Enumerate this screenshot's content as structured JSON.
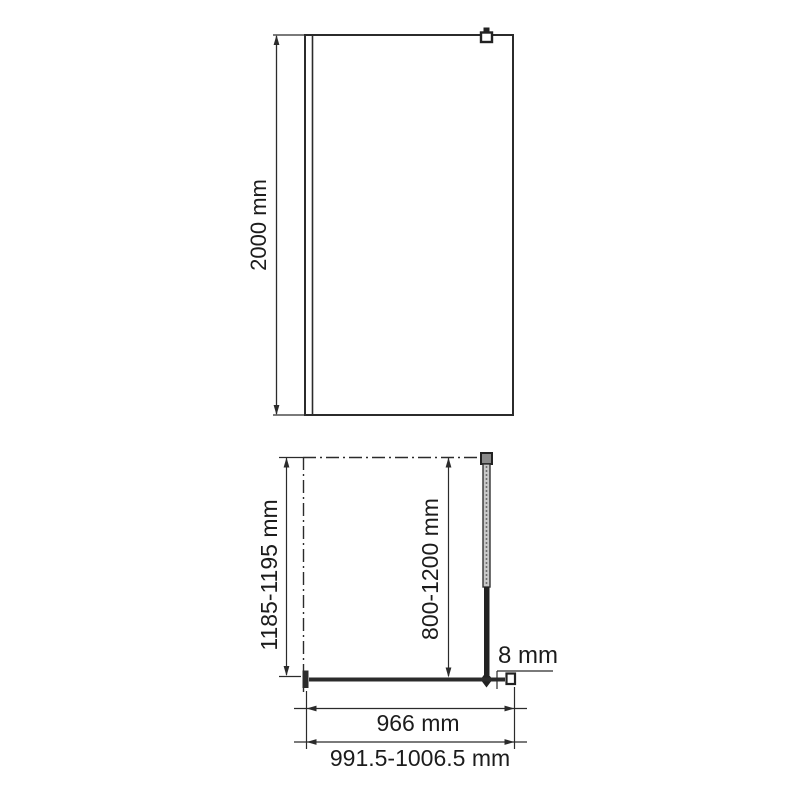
{
  "drawing": {
    "type": "technical-dimension-drawing",
    "subject": "walk-in shower glass screen, front elevation and plan view",
    "front_view": {
      "height_label": "2000 mm"
    },
    "plan_view": {
      "depth_label": "1185-1195 mm",
      "support_bar_length_label": "800-1200 mm",
      "glass_thickness_label": "8 mm",
      "glass_width_label": "966 mm",
      "overall_width_label": "991.5-1006.5 mm"
    },
    "colors": {
      "line": "#2b2b2b",
      "dim_line": "#2b2b2b",
      "text": "#1c1c1c",
      "bar_fill": "#c9c9c9",
      "background": "#ffffff"
    }
  }
}
